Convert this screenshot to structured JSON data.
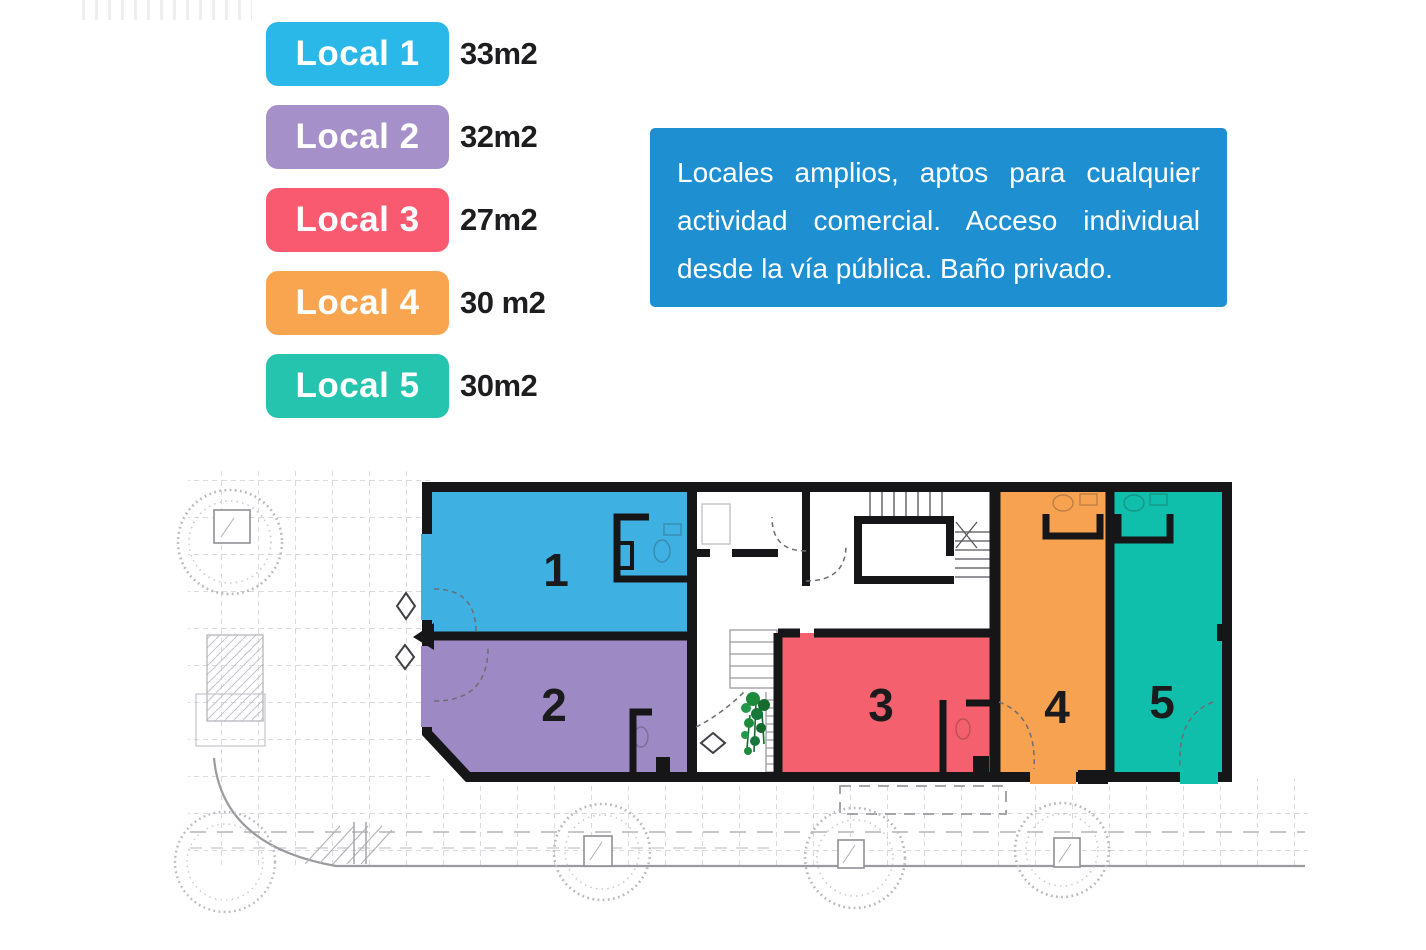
{
  "legend": {
    "items": [
      {
        "label": "Local 1",
        "area": "33m2",
        "badge_color": "#29b8e8",
        "room_color": "#3eb1e2"
      },
      {
        "label": "Local 2",
        "area": "32m2",
        "badge_color": "#a590c9",
        "room_color": "#9d89c3"
      },
      {
        "label": "Local 3",
        "area": "27m2",
        "badge_color": "#f95a70",
        "room_color": "#f4606d"
      },
      {
        "label": "Local 4",
        "area": "30 m2",
        "badge_color": "#f9a44e",
        "room_color": "#f7a250"
      },
      {
        "label": "Local 5",
        "area": "30m2",
        "badge_color": "#25c4ae",
        "room_color": "#10bfab"
      }
    ]
  },
  "info_box": {
    "bg_color": "#1e8fd1",
    "lines": [
      "Locales amplios, aptos para cualquier",
      "actividad comercial. Acceso individual",
      "desde la vía pública. Baño privado."
    ]
  },
  "plan": {
    "room_numbers": [
      "1",
      "2",
      "3",
      "4",
      "5"
    ]
  }
}
